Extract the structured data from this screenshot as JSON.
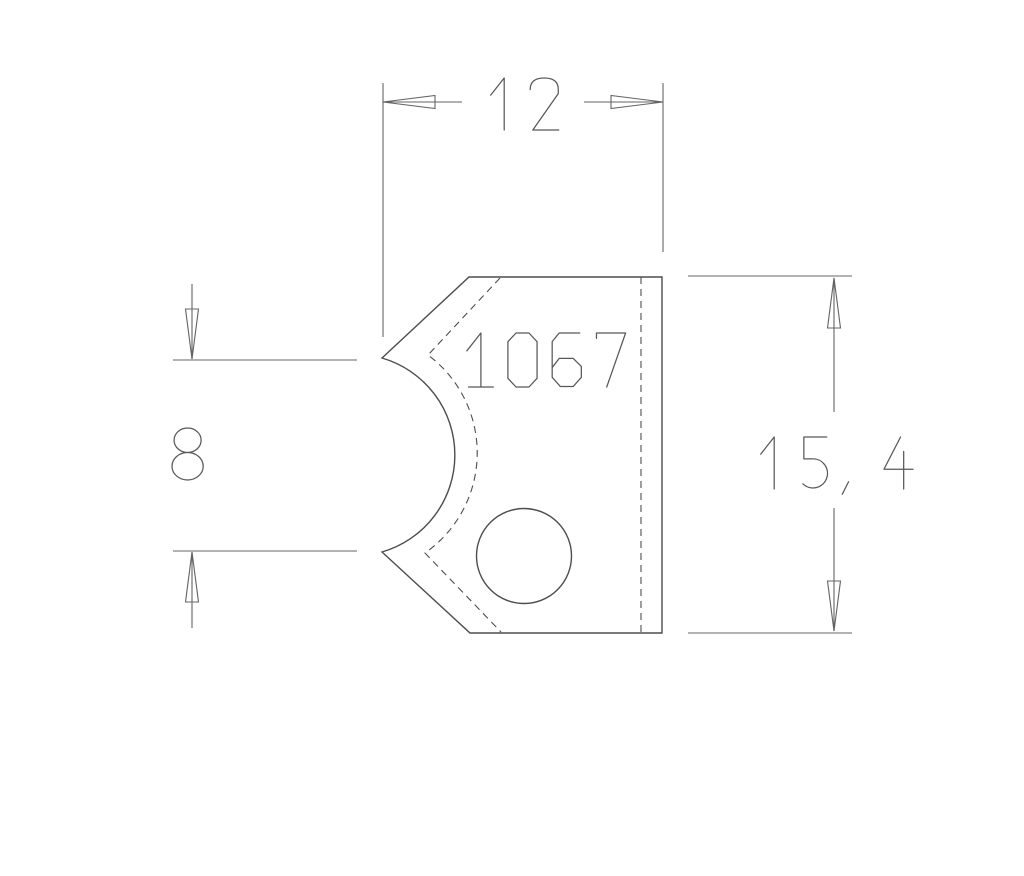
{
  "page": {
    "background": "#ffffff"
  },
  "drawing": {
    "part_number": "1067",
    "dimensions": {
      "width": "12",
      "height": "15, 4",
      "notch_height": "8"
    },
    "colors": {
      "outline": "#4d4d4d",
      "dimension": "#646464",
      "text": "#585858",
      "background": "#ffffff"
    }
  }
}
